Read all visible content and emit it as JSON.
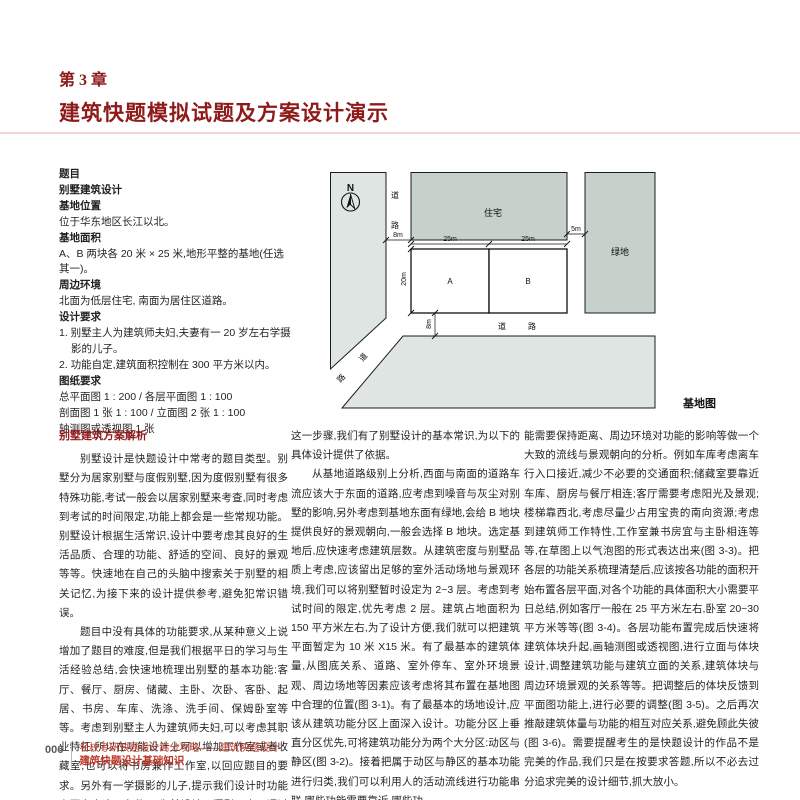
{
  "header": {
    "chapter_label": "第 3 章",
    "chapter_title": "建筑快题模拟试题及方案设计演示"
  },
  "brief": {
    "items": [
      {
        "text": "题目"
      },
      {
        "text": "别墅建筑设计"
      },
      {
        "text": "基地位置"
      },
      {
        "text": "位于华东地区长江以北。"
      },
      {
        "text": "基地面积"
      },
      {
        "text": "A、B 两块各 20 米 × 25 米,地形平整的基地(任选其一)。"
      },
      {
        "text": "周边环境"
      },
      {
        "text": "北面为低层住宅, 南面为居住区道路。"
      },
      {
        "text": "设计要求"
      },
      {
        "text": "1. 别墅主人为建筑师夫妇,夫妻有一 20 岁左右学摄影的儿子。"
      },
      {
        "text": "2. 功能自定,建筑面积控制在 300 平方米以内。"
      },
      {
        "text": "图纸要求"
      },
      {
        "text": "总平面图 1 : 200 / 各层平面图 1 : 100"
      },
      {
        "text": "剖面图 1 张 1 : 100 / 立面图 2 张 1 : 100"
      },
      {
        "text": "轴测图或透视图 1 张"
      }
    ]
  },
  "diagram": {
    "caption": "基地图",
    "north_label": "N",
    "labels": {
      "residential": "住宅",
      "green_space": "绿地",
      "plot_a": "A",
      "plot_b": "B",
      "road_left_1": "道",
      "road_left_2": "路",
      "road_bottom_1": "道",
      "road_bottom_2": "路",
      "road_diag_1": "道",
      "road_diag_2": "路"
    },
    "dims": {
      "left_road_width": "8m",
      "plot_a_width": "25m",
      "plot_b_width": "25m",
      "plot_depth": "20m",
      "right_road_width": "5m",
      "bottom_road_width": "8m"
    }
  },
  "analysis": {
    "heading": "别墅建筑方案解析",
    "col1_p1": "别墅设计是快题设计中常考的题目类型。别墅分为居家别墅与度假别墅,因为度假别墅有很多特殊功能,考试一般会以居家别墅来考查,同时考虑到考试的时间限定,功能上都会是一些常规功能。别墅设计根据生活常识,设计中要考虑其良好的生活品质、合理的功能、舒适的空间、良好的景观等等。快速地在自己的头脑中搜索关于别墅的相关记忆,为接下来的设计提供参考,避免犯常识错误。",
    "col1_p2": "题目中没有具体的功能要求,从某种意义上说增加了题目的难度,但是我们根据平日的学习与生活经验总结,会快速地梳理出别墅的基本功能:客厅、餐厅、厨房、储藏、主卧、次卧、客卧、起居、书房、车库、洗涤、洗手间、保姆卧室等等。考虑到别墅主人为建筑师夫妇,可以考虑其职业特征,所以在功能设计上可以增加工作室或者收藏室,也可以将书房兼作工作室,以回应题目的要求。另外有一学摄影的儿子,提示我们设计时功能上要考虑这一条件,可为其设计一摄影用房。通过以上",
    "col2_p1": "这一步骤,我们有了别墅设计的基本常识,为以下的具体设计提供了依据。",
    "col2_p2": "从基地道路级别上分析,西面与南面的道路车流应该大于东面的道路,应考虑到噪音与灰尘对别墅的影响,另外考虑到基地东面有绿地,会给 B 地块提供良好的景观朝向,一般会选择 B 地块。选定基地后,应快速考虑建筑层数。从建筑密度与别墅品质上考虑,应该留出足够的室外活动场地与景观环境,我们可以将别墅暂时设定为 2~3 层。考虑到考试时间的限定,优先考虑 2 层。建筑占地面积为 150 平方米左右,为了设计方便,我们就可以把建筑平面暂定为 10 米 X15 米。有了最基本的建筑体量,从图底关系、道路、室外停车、室外环境景观、周边场地等因素应该考虑将其布置在基地图中合理的位置(图 3-1)。有了最基本的场地设计,应该从建筑功能分区上面深入设计。功能分区上垂直分区优先,可将建筑功能分为两个大分区:动区与静区(图 3-2)。接着把属于动区与静区的基本功能进行归类,我们可以利用人的活动流线进行功能串联,哪些功能需要靠近,哪些功",
    "col3_p1": "能需要保持距离、周边环境对功能的影响等做一个大致的流线与景观朝向的分析。例如车库考虑离车行入口接近,减少不必要的交通面积;储藏室要靠近车库、厨房与餐厅相连;客厅需要考虑阳光及景观;楼梯靠西北,考虑尽量少占用宝贵的南向资源;考虑到建筑师工作特性,工作室兼书房宜与主卧相连等等,在草图上以气泡图的形式表达出来(图 3-3)。把各层的功能关系梳理清楚后,应该按各功能的面积开始布置各层平面,对各个功能的具体面积大小需要平日总结,例如客厅一般在 25 平方米左右,卧室 20~30 平方米等等(图 3-4)。各层功能布置完成后快速将建筑体块升起,画轴测图或透视图,进行立面与体块设计,调整建筑功能与建筑立面的关系,建筑体块与周边环境景观的关系等等。把调整后的体块反馈到平面图功能上,进行必要的调整(图 3-5)。之后再次推敲建筑体量与功能的相互对应关系,避免顾此失彼(图 3-6)。需要提醒考生的是快题设计的作品不是完美的作品,我们只是在按要求答题,所以不必去过分追求完美的设计细节,抓大放小。"
  },
  "footer": {
    "page_number": "006",
    "book_title": "名校考研快题设计高分攻略——建筑快题设计",
    "section_title": "建筑快题设计基础知识"
  },
  "colors": {
    "accent_red": "#8e1a1a",
    "footer_red": "#bf3a2b",
    "block_green": "#c6d1cb",
    "block_light": "#dfe5e2",
    "divider_pink": "#f2dad3"
  }
}
